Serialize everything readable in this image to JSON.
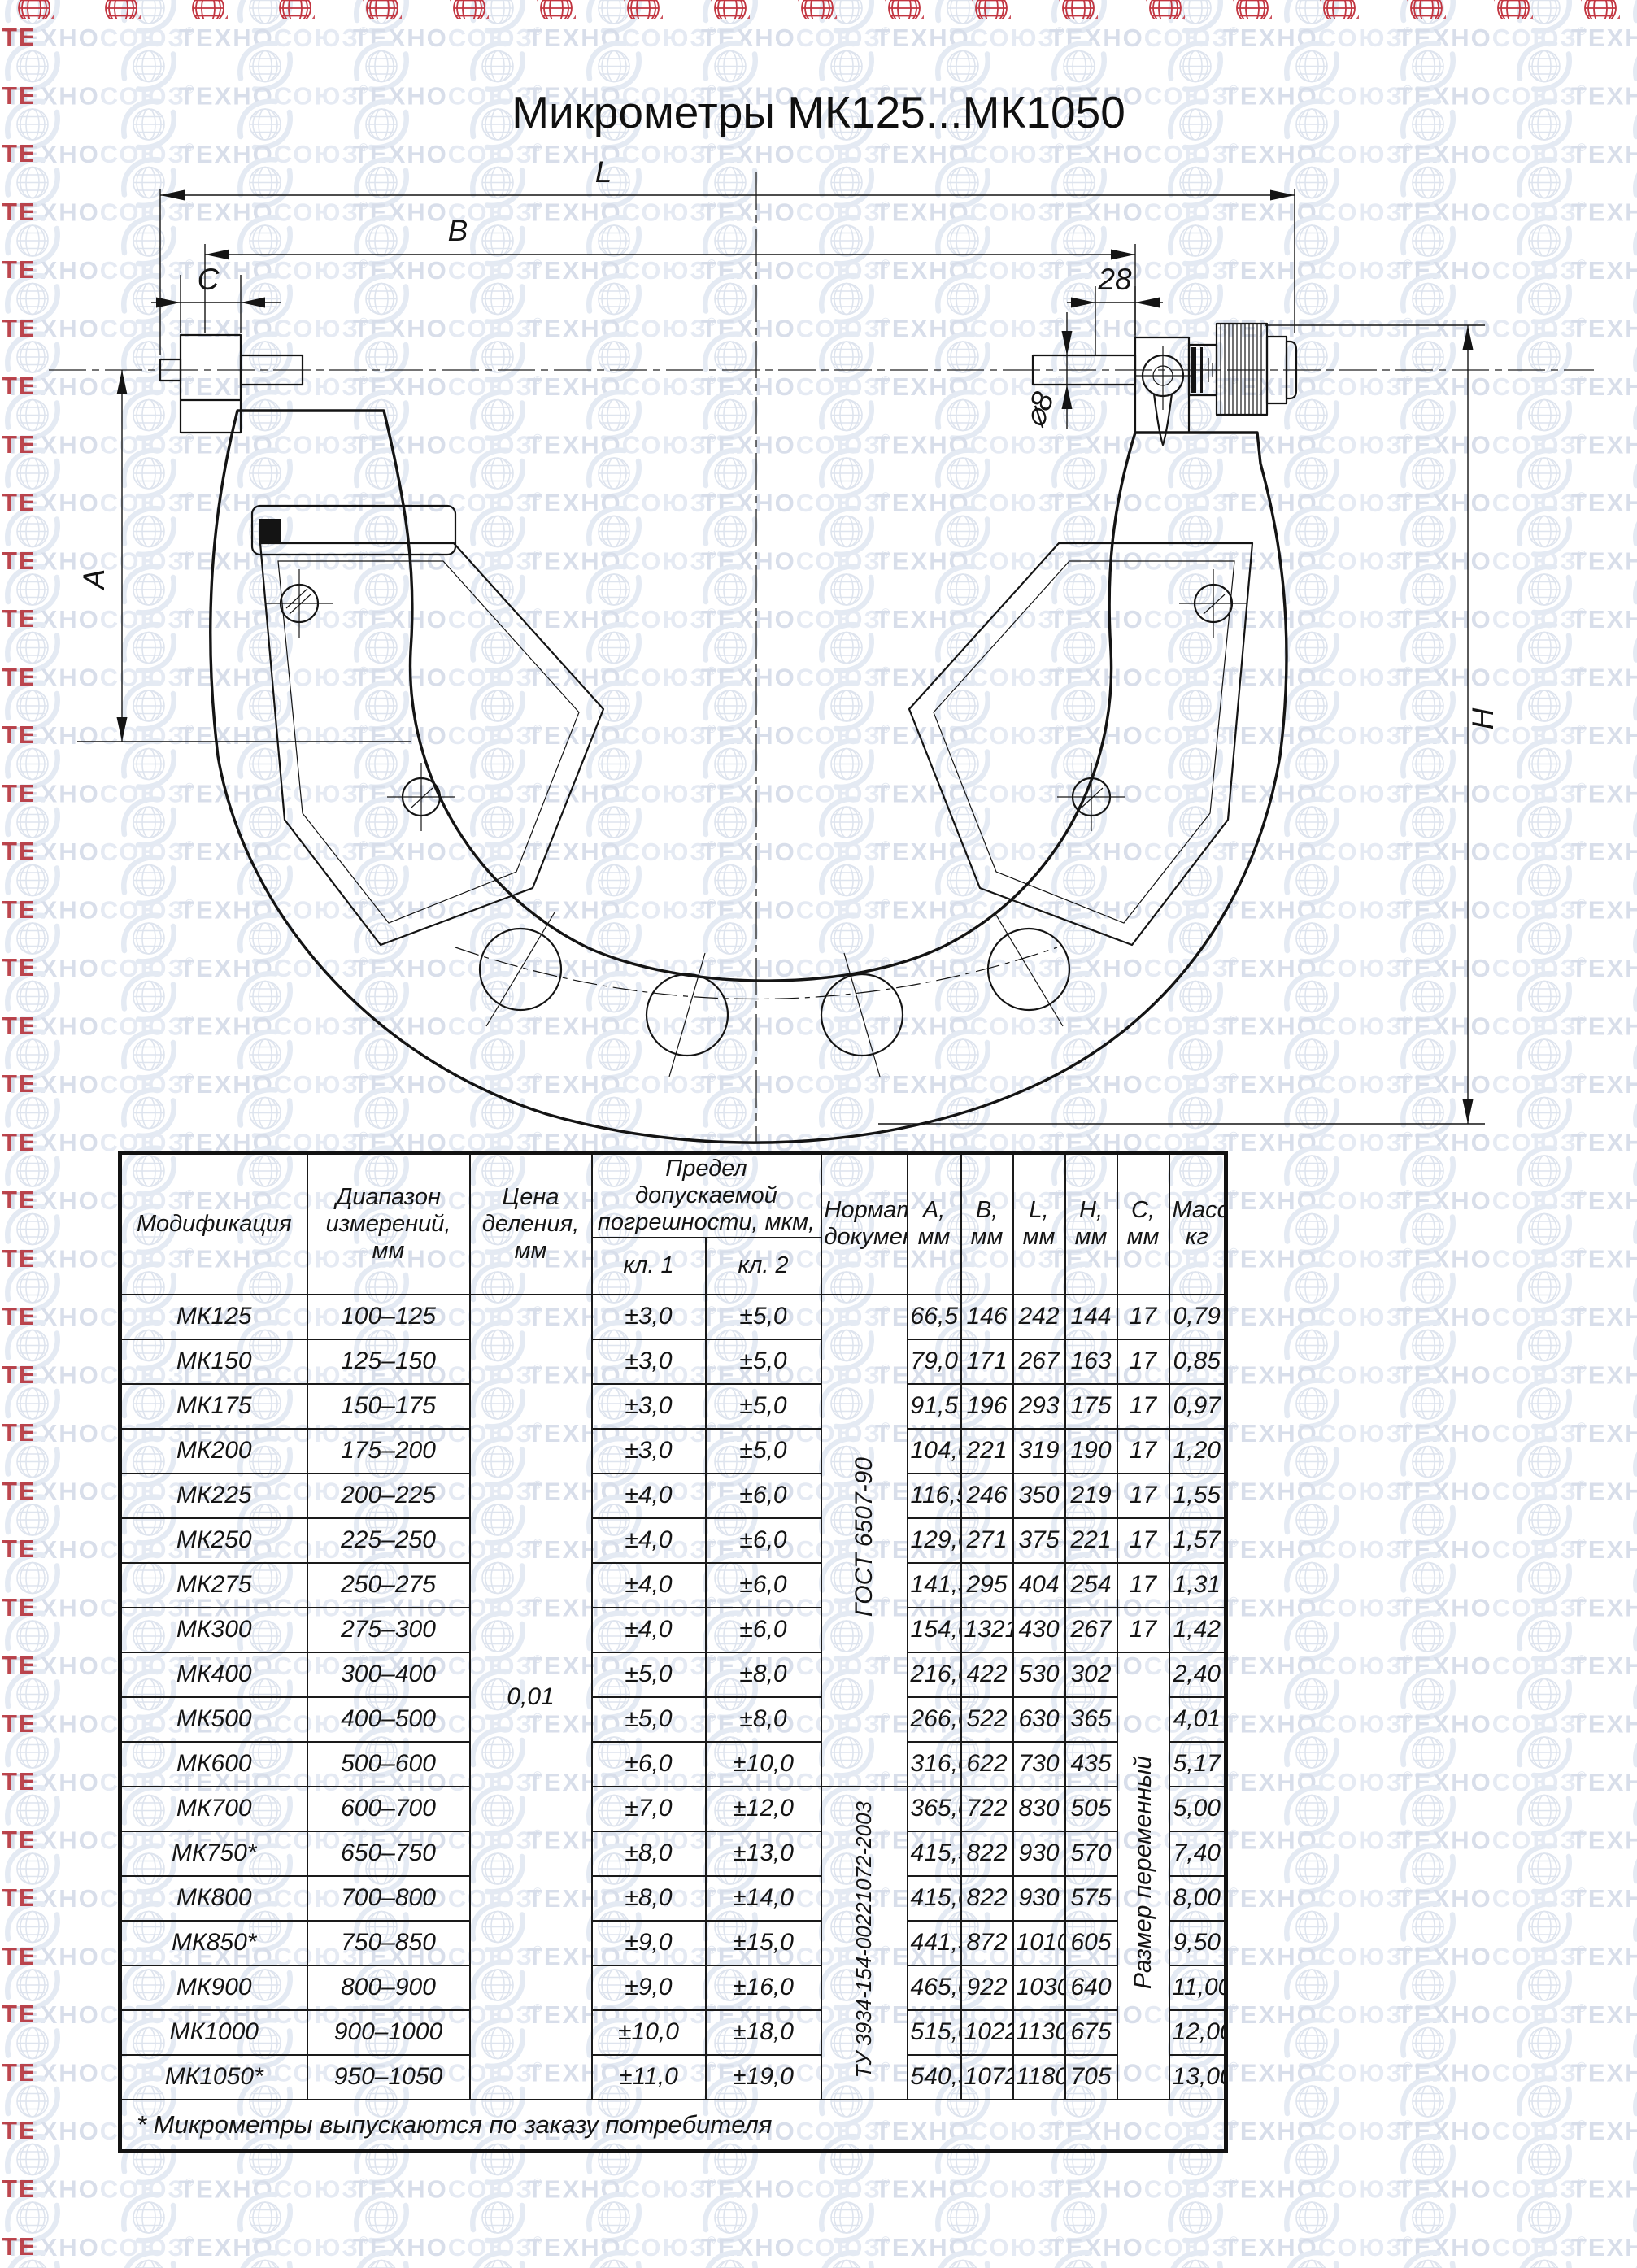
{
  "watermark": {
    "brand_primary": "ТЕХНО",
    "brand_secondary": "СОЮЗ",
    "registered": "®",
    "color_dark": "#d8deea",
    "color_light": "#e5eaf3",
    "edge_red": "#b2262f"
  },
  "title": "Микрометры МК125...МК1050",
  "drawing": {
    "dim_labels": {
      "length_l": "L",
      "length_b": "B",
      "length_c": "C",
      "spindle_offset": "28",
      "spindle_dia": "⌀8",
      "throat_a": "A",
      "height_h": "H"
    }
  },
  "table": {
    "header": {
      "modification": "Модификация",
      "range": "Диапазон измерений, мм",
      "division": "Цена деления, мм",
      "error_limit": "Предел допускаемой погрешности, мкм,",
      "class1": "кл. 1",
      "class2": "кл. 2",
      "normative": "Нормативный документ",
      "dim_columns": [
        {
          "label": "A,",
          "unit": "мм"
        },
        {
          "label": "B,",
          "unit": "мм"
        },
        {
          "label": "L,",
          "unit": "мм"
        },
        {
          "label": "H,",
          "unit": "мм"
        },
        {
          "label": "C,",
          "unit": "мм"
        }
      ],
      "mass": {
        "label": "Масса,",
        "unit": "кг"
      }
    },
    "division_value": "0,01",
    "normative_docs": [
      {
        "label": "ГОСТ 6507-90",
        "row_start": 0,
        "row_span": 11
      },
      {
        "label": "ТУ 3934-154-00221072-2003",
        "row_start": 11,
        "row_span": 7
      }
    ],
    "c_merged_label": "Размер переменный",
    "c_merged_start": 8,
    "rows": [
      {
        "model": "МК125",
        "range": "100–125",
        "cl1": "±3,0",
        "cl2": "±5,0",
        "a": "66,5",
        "b": "146",
        "l": "242",
        "h": "144",
        "c": "17",
        "mass": "0,79"
      },
      {
        "model": "МК150",
        "range": "125–150",
        "cl1": "±3,0",
        "cl2": "±5,0",
        "a": "79,0",
        "b": "171",
        "l": "267",
        "h": "163",
        "c": "17",
        "mass": "0,85"
      },
      {
        "model": "МК175",
        "range": "150–175",
        "cl1": "±3,0",
        "cl2": "±5,0",
        "a": "91,5",
        "b": "196",
        "l": "293",
        "h": "175",
        "c": "17",
        "mass": "0,97"
      },
      {
        "model": "МК200",
        "range": "175–200",
        "cl1": "±3,0",
        "cl2": "±5,0",
        "a": "104,0",
        "b": "221",
        "l": "319",
        "h": "190",
        "c": "17",
        "mass": "1,20"
      },
      {
        "model": "МК225",
        "range": "200–225",
        "cl1": "±4,0",
        "cl2": "±6,0",
        "a": "116,5",
        "b": "246",
        "l": "350",
        "h": "219",
        "c": "17",
        "mass": "1,55"
      },
      {
        "model": "МК250",
        "range": "225–250",
        "cl1": "±4,0",
        "cl2": "±6,0",
        "a": "129,0",
        "b": "271",
        "l": "375",
        "h": "221",
        "c": "17",
        "mass": "1,57"
      },
      {
        "model": "МК275",
        "range": "250–275",
        "cl1": "±4,0",
        "cl2": "±6,0",
        "a": "141,5",
        "b": "295",
        "l": "404",
        "h": "254",
        "c": "17",
        "mass": "1,31"
      },
      {
        "model": "МК300",
        "range": "275–300",
        "cl1": "±4,0",
        "cl2": "±6,0",
        "a": "154,0",
        "b": "1321",
        "l": "430",
        "h": "267",
        "c": "17",
        "mass": "1,42"
      },
      {
        "model": "МК400",
        "range": "300–400",
        "cl1": "±5,0",
        "cl2": "±8,0",
        "a": "216,0",
        "b": "422",
        "l": "530",
        "h": "302",
        "c": null,
        "mass": "2,40"
      },
      {
        "model": "МК500",
        "range": "400–500",
        "cl1": "±5,0",
        "cl2": "±8,0",
        "a": "266,0",
        "b": "522",
        "l": "630",
        "h": "365",
        "c": null,
        "mass": "4,01"
      },
      {
        "model": "МК600",
        "range": "500–600",
        "cl1": "±6,0",
        "cl2": "±10,0",
        "a": "316,0",
        "b": "622",
        "l": "730",
        "h": "435",
        "c": null,
        "mass": "5,17"
      },
      {
        "model": "МК700",
        "range": "600–700",
        "cl1": "±7,0",
        "cl2": "±12,0",
        "a": "365,0",
        "b": "722",
        "l": "830",
        "h": "505",
        "c": null,
        "mass": "5,00"
      },
      {
        "model": "МК750*",
        "range": "650–750",
        "cl1": "±8,0",
        "cl2": "±13,0",
        "a": "415,5",
        "b": "822",
        "l": "930",
        "h": "570",
        "c": null,
        "mass": "7,40"
      },
      {
        "model": "МК800",
        "range": "700–800",
        "cl1": "±8,0",
        "cl2": "±14,0",
        "a": "415,0",
        "b": "822",
        "l": "930",
        "h": "575",
        "c": null,
        "mass": "8,00"
      },
      {
        "model": "МК850*",
        "range": "750–850",
        "cl1": "±9,0",
        "cl2": "±15,0",
        "a": "441,5",
        "b": "872",
        "l": "1010",
        "h": "605",
        "c": null,
        "mass": "9,50"
      },
      {
        "model": "МК900",
        "range": "800–900",
        "cl1": "±9,0",
        "cl2": "±16,0",
        "a": "465,0",
        "b": "922",
        "l": "1030",
        "h": "640",
        "c": null,
        "mass": "11,00"
      },
      {
        "model": "МК1000",
        "range": "900–1000",
        "cl1": "±10,0",
        "cl2": "±18,0",
        "a": "515,0",
        "b": "1022",
        "l": "1130",
        "h": "675",
        "c": null,
        "mass": "12,00"
      },
      {
        "model": "МК1050*",
        "range": "950–1050",
        "cl1": "±11,0",
        "cl2": "±19,0",
        "a": "540,5",
        "b": "1072",
        "l": "1180",
        "h": "705",
        "c": null,
        "mass": "13,00"
      }
    ],
    "footnote": "* Микрометры выпускаются по заказу потребителя"
  }
}
